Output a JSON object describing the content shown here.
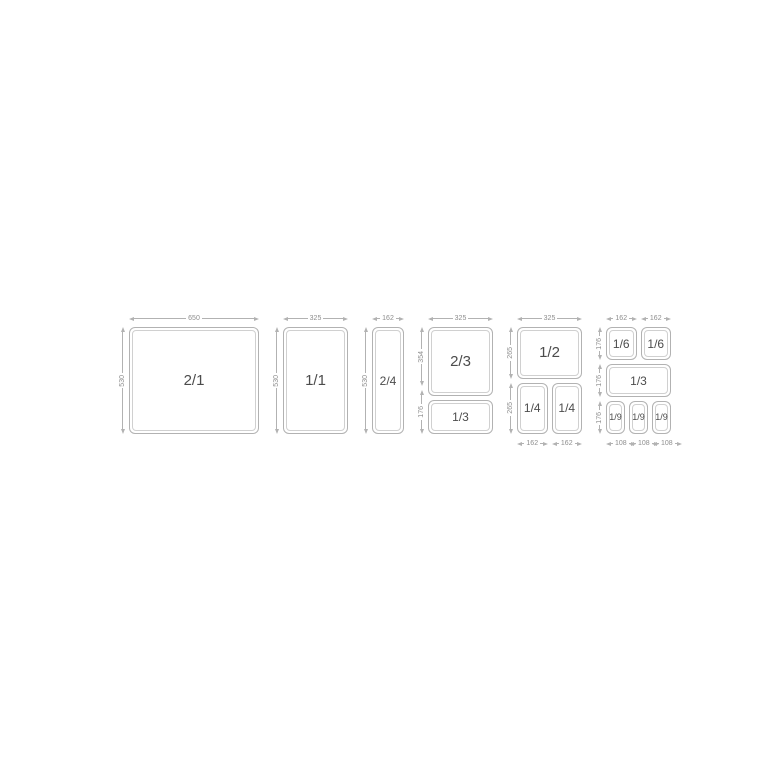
{
  "colors": {
    "background": "#ffffff",
    "line": "#b2b2b2",
    "inner_line": "#d0d0d0",
    "dimension_text": "#8e8e8e",
    "pan_label_text": "#4c4c4c"
  },
  "diagram": {
    "name": "gastronorm-pan-size-diagram",
    "sections": [
      {
        "name": "section-gn-2-1",
        "total_w_mm": 650,
        "top_dims": [
          {
            "label": "650",
            "mm": 650
          }
        ],
        "left_dims": [
          {
            "label": "530",
            "mm": 530
          }
        ],
        "bottom_dims": [],
        "rows": [
          {
            "h_mm": 530,
            "pans": [
              {
                "label": "2/1",
                "w_mm": 650,
                "size": "lg"
              }
            ]
          }
        ]
      },
      {
        "name": "section-gn-1-1",
        "total_w_mm": 325,
        "top_dims": [
          {
            "label": "325",
            "mm": 325
          }
        ],
        "left_dims": [
          {
            "label": "530",
            "mm": 530
          }
        ],
        "bottom_dims": [],
        "rows": [
          {
            "h_mm": 530,
            "pans": [
              {
                "label": "1/1",
                "w_mm": 325,
                "size": "lg"
              }
            ]
          }
        ]
      },
      {
        "name": "section-gn-2-4",
        "total_w_mm": 162,
        "top_dims": [
          {
            "label": "162",
            "mm": 162
          }
        ],
        "left_dims": [
          {
            "label": "530",
            "mm": 530
          }
        ],
        "bottom_dims": [],
        "rows": [
          {
            "h_mm": 530,
            "pans": [
              {
                "label": "2/4",
                "w_mm": 162,
                "size": "md"
              }
            ]
          }
        ]
      },
      {
        "name": "section-gn-2-3-and-1-3",
        "total_w_mm": 325,
        "top_dims": [
          {
            "label": "325",
            "mm": 325
          }
        ],
        "left_dims": [
          {
            "label": "354",
            "mm": 354
          },
          {
            "label": "176",
            "mm": 176
          }
        ],
        "bottom_dims": [],
        "rows": [
          {
            "h_mm": 354,
            "pans": [
              {
                "label": "2/3",
                "w_mm": 325,
                "size": "lg"
              }
            ]
          },
          {
            "h_mm": 176,
            "pans": [
              {
                "label": "1/3",
                "w_mm": 325,
                "size": "md"
              }
            ]
          }
        ]
      },
      {
        "name": "section-gn-1-2-and-1-4",
        "total_w_mm": 325,
        "top_dims": [
          {
            "label": "325",
            "mm": 325
          }
        ],
        "left_dims": [
          {
            "label": "265",
            "mm": 265
          },
          {
            "label": "265",
            "mm": 265
          }
        ],
        "bottom_dims": [
          {
            "label": "162",
            "mm": 162
          },
          {
            "label": "162",
            "mm": 162
          }
        ],
        "rows": [
          {
            "h_mm": 265,
            "pans": [
              {
                "label": "1/2",
                "w_mm": 325,
                "size": "lg"
              }
            ]
          },
          {
            "h_mm": 265,
            "pans": [
              {
                "label": "1/4",
                "w_mm": 162,
                "size": "md"
              },
              {
                "label": "1/4",
                "w_mm": 162,
                "size": "md"
              }
            ]
          }
        ]
      },
      {
        "name": "section-gn-1-6-1-3-1-9",
        "total_w_mm": 324,
        "top_dims": [
          {
            "label": "162",
            "mm": 162
          },
          {
            "label": "162",
            "mm": 162
          }
        ],
        "left_dims": [
          {
            "label": "176",
            "mm": 176
          },
          {
            "label": "176",
            "mm": 176
          },
          {
            "label": "176",
            "mm": 176
          }
        ],
        "bottom_dims": [
          {
            "label": "108",
            "mm": 108
          },
          {
            "label": "108",
            "mm": 108
          },
          {
            "label": "108",
            "mm": 108
          }
        ],
        "rows": [
          {
            "h_mm": 176,
            "pans": [
              {
                "label": "1/6",
                "w_mm": 162,
                "size": "md"
              },
              {
                "label": "1/6",
                "w_mm": 162,
                "size": "md"
              }
            ]
          },
          {
            "h_mm": 176,
            "pans": [
              {
                "label": "1/3",
                "w_mm": 324,
                "size": "md"
              }
            ]
          },
          {
            "h_mm": 176,
            "pans": [
              {
                "label": "1/9",
                "w_mm": 108,
                "size": "sm"
              },
              {
                "label": "1/9",
                "w_mm": 108,
                "size": "sm"
              },
              {
                "label": "1/9",
                "w_mm": 108,
                "size": "sm"
              }
            ]
          }
        ]
      }
    ]
  }
}
